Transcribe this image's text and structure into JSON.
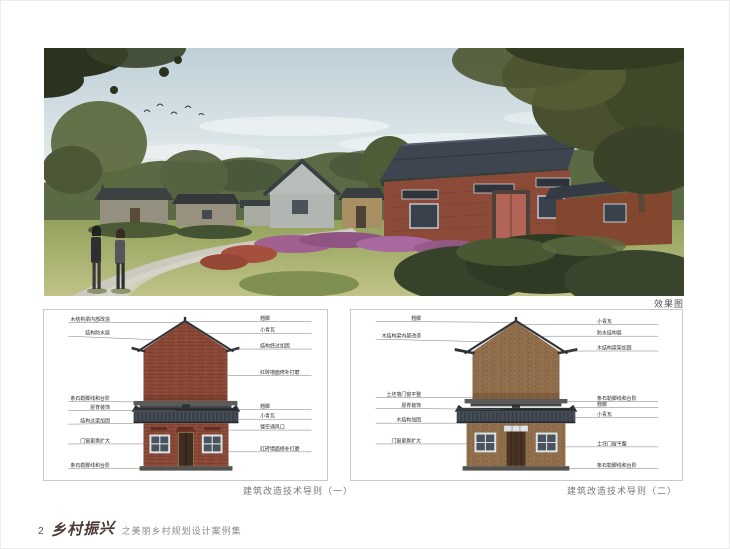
{
  "page": {
    "render_caption": "效果图",
    "footer": {
      "page_number": "2",
      "brand": "乡村振兴",
      "subtitle": "之美丽乡村规划设计案例集"
    }
  },
  "panels": {
    "left": {
      "caption": "建筑改造技术导则（一）",
      "gable": {
        "left_labels": [
          "木结构梁内部改造",
          "结构防水层",
          "条石勒脚线和台阶"
        ],
        "right_labels": [
          "翘脚",
          "小青瓦",
          "结构经过加固",
          "红砖墙面修补打磨"
        ]
      },
      "front": {
        "left_labels": [
          "屋脊装饰",
          "结构过梁加固",
          "门窗更换扩大",
          "条石勒脚线和台阶"
        ],
        "right_labels": [
          "翘脚",
          "小青瓦",
          "镂空通风口",
          "红砖墙面修补打磨"
        ]
      }
    },
    "right": {
      "caption": "建筑改造技术导则（二）",
      "gable": {
        "left_labels": [
          "翘脚",
          "木结构梁内部改造",
          "土坯墙门窗平整"
        ],
        "right_labels": [
          "小青瓦",
          "防水结构层",
          "木结构梁架加固",
          "条石勒脚线和台阶"
        ]
      },
      "front": {
        "left_labels": [
          "屋脊装饰",
          "木结构加固",
          "门窗更换扩大"
        ],
        "right_labels": [
          "翘脚",
          "小青瓦",
          "土坯门窗平整",
          "条石勒脚线和台阶"
        ]
      }
    }
  },
  "colors": {
    "brick_wall": "#8c4a38",
    "earth_wall": "#92704e",
    "roof_tile": "#3a414b",
    "caption_text": "#777777"
  }
}
